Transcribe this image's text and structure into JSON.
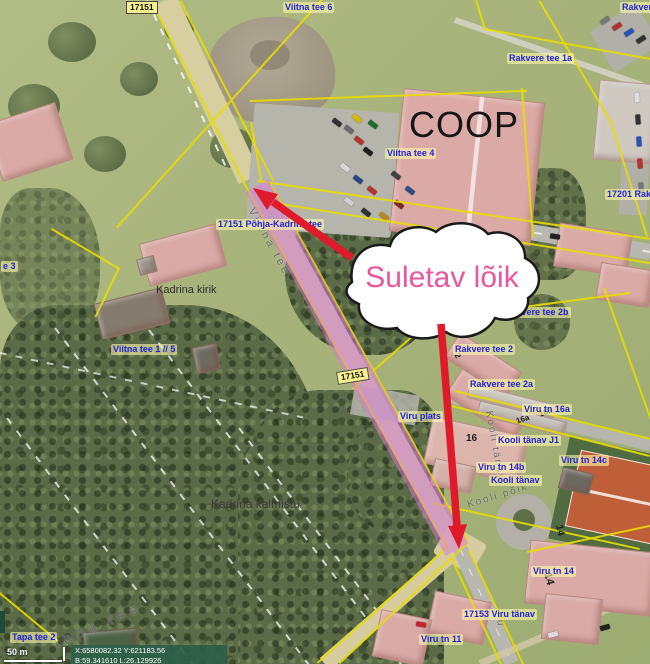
{
  "annotation": {
    "bubble": "Suletav lõik"
  },
  "labels": {
    "badge_17151_top": "17151",
    "badge_17151_mid": "17151",
    "viitna_tee_6": "Viitna tee 6",
    "rakvere_partial_topright": "Rakvere",
    "rakvere_tee_1a": "Rakvere tee 1a",
    "coop": "COOP",
    "viitna_tee_4": "Viitna tee 4",
    "road_17201_partial": "17201 Rakve",
    "pohja_kadrina_tee": "17151 Põhja-Kadrina tee",
    "viitna_tee_street": "Viitna tee",
    "kadrina_kirik": "Kadrina kirik",
    "viitna_tee_3_partial": "e 3",
    "viitna_tee_1_5": "Viitna tee 1 // 5",
    "kadrina_kalmistu": "Kadrina kalmistu",
    "rakvere_tee_2b": "Rakvere tee 2b",
    "rakvere_tee_2": "Rakvere tee 2",
    "rakvere_tee_2a": "Rakvere tee 2a",
    "viru_plats": "Viru plats",
    "viru_tn_16a": "Viru tn 16a",
    "kooli_tanav_j1": "Kooli tänav J1",
    "viru_tn_14c": "Viru tn 14c",
    "viru_tn_14b": "Viru tn 14b",
    "kooli_tanav": "Kooli tänav",
    "kooli_tanav_street": "Kooli tänav",
    "kooli_poik_street": "Kooli põik",
    "viru_street_partial": "iru",
    "viru_tn_14": "Viru tn 14",
    "viru_tanav_17153": "17153 Viru tänav",
    "viru_tn_11": "Viru tn 11",
    "tapa_tee_street": "Tapa tee",
    "tapa_tee_2": "Tapa tee 2"
  },
  "parcels": {
    "p2": "2",
    "p2a": "2a",
    "p16": "16",
    "p16a": "16a",
    "p16b": "16b",
    "p14_upper": "14",
    "p14_lower": "14"
  },
  "statusbar": {
    "scale": "50 m",
    "coords_line1": "X:6580082.32 Y:621183.56",
    "coords_line2": "B:59.341610 L:26.129926"
  },
  "colors": {
    "closure_highlight": "#db78d6",
    "arrow_red": "#df1b2b",
    "bubble_text_pink": "#e8579d",
    "cadastral_yellow": "#e9db00",
    "address_label_blue": "#2323d8"
  }
}
